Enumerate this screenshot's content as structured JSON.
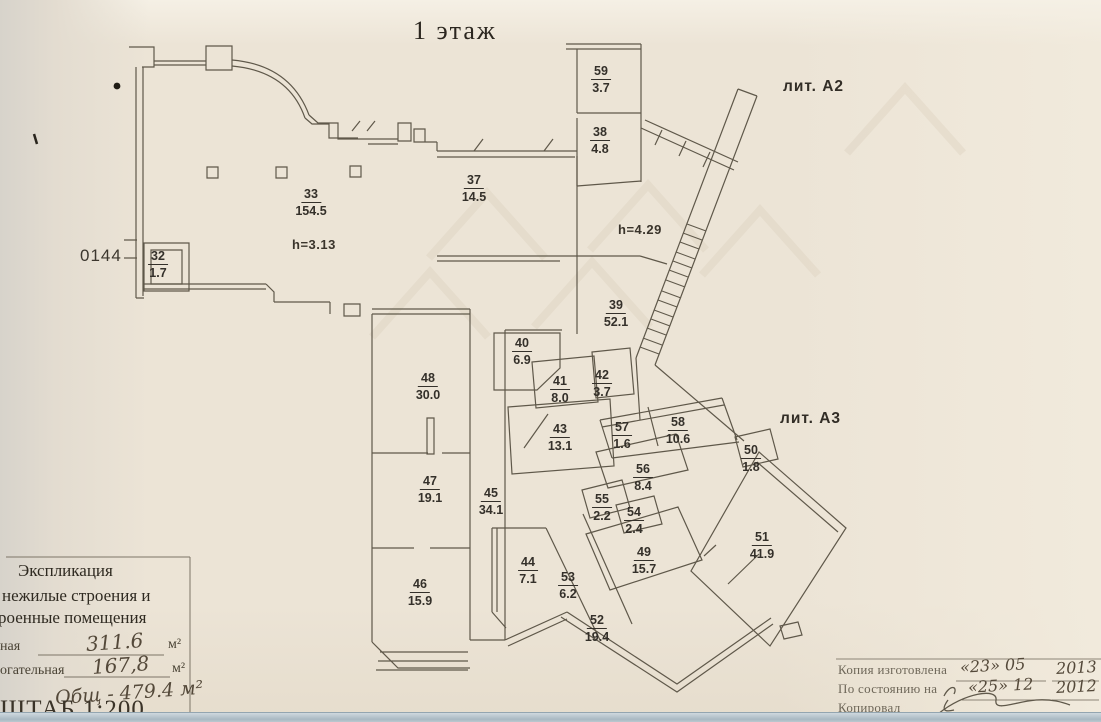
{
  "title": "1 этаж",
  "plan": {
    "lit_a2": "лит. А2",
    "lit_a3": "лит. А3",
    "height_33": "h=3.13",
    "height_39": "h=4.29",
    "inventory_number": "0144",
    "rooms": [
      {
        "number": "59",
        "area": "3.7",
        "x": 601,
        "y": 64
      },
      {
        "number": "38",
        "area": "4.8",
        "x": 600,
        "y": 125
      },
      {
        "number": "37",
        "area": "14.5",
        "x": 474,
        "y": 173
      },
      {
        "number": "33",
        "area": "154.5",
        "x": 311,
        "y": 187
      },
      {
        "number": "32",
        "area": "1.7",
        "x": 158,
        "y": 249
      },
      {
        "number": "39",
        "area": "52.1",
        "x": 616,
        "y": 298
      },
      {
        "number": "40",
        "area": "6.9",
        "x": 522,
        "y": 336
      },
      {
        "number": "41",
        "area": "8.0",
        "x": 560,
        "y": 374
      },
      {
        "number": "42",
        "area": "3.7",
        "x": 602,
        "y": 368
      },
      {
        "number": "43",
        "area": "13.1",
        "x": 560,
        "y": 422
      },
      {
        "number": "48",
        "area": "30.0",
        "x": 428,
        "y": 371
      },
      {
        "number": "47",
        "area": "19.1",
        "x": 430,
        "y": 474
      },
      {
        "number": "45",
        "area": "34.1",
        "x": 491,
        "y": 486
      },
      {
        "number": "46",
        "area": "15.9",
        "x": 420,
        "y": 577
      },
      {
        "number": "57",
        "area": "1.6",
        "x": 622,
        "y": 420
      },
      {
        "number": "58",
        "area": "10.6",
        "x": 678,
        "y": 415
      },
      {
        "number": "56",
        "area": "8.4",
        "x": 643,
        "y": 462
      },
      {
        "number": "55",
        "area": "2.2",
        "x": 602,
        "y": 492
      },
      {
        "number": "54",
        "area": "2.4",
        "x": 634,
        "y": 505
      },
      {
        "number": "50",
        "area": "1.8",
        "x": 751,
        "y": 443
      },
      {
        "number": "49",
        "area": "15.7",
        "x": 644,
        "y": 545
      },
      {
        "number": "44",
        "area": "7.1",
        "x": 528,
        "y": 555
      },
      {
        "number": "53",
        "area": "6.2",
        "x": 568,
        "y": 570
      },
      {
        "number": "51",
        "area": "41.9",
        "x": 762,
        "y": 530
      },
      {
        "number": "52",
        "area": "19.4",
        "x": 597,
        "y": 613
      }
    ]
  },
  "legend": {
    "title": "Экспликация",
    "line2": "нежилые строения и",
    "line3": "роенные помещения",
    "row1_label": "ная",
    "row1_value": "311.6",
    "row1_unit": "м²",
    "row2_label": "огательная",
    "row2_value": "167,8",
    "row2_unit": "м²",
    "total": "Общ - 479.4 м²",
    "scale": "ШТАБ 1:200"
  },
  "stamp": {
    "line1_label": "Копия изготовлена",
    "line1_date": "«23» 05",
    "line1_year": "2013",
    "line2_label": "По состоянию на",
    "line2_date": "«25» 12",
    "line2_year": "2012",
    "line3_label": "Копировал",
    "line4_label": "Проверил"
  },
  "colors": {
    "paper": "#ece4d6",
    "wall_ink": "#5f584a",
    "text_ink": "#34302a",
    "watermark": "#ddd3c1",
    "bottom_strip": "#aebbc4"
  }
}
